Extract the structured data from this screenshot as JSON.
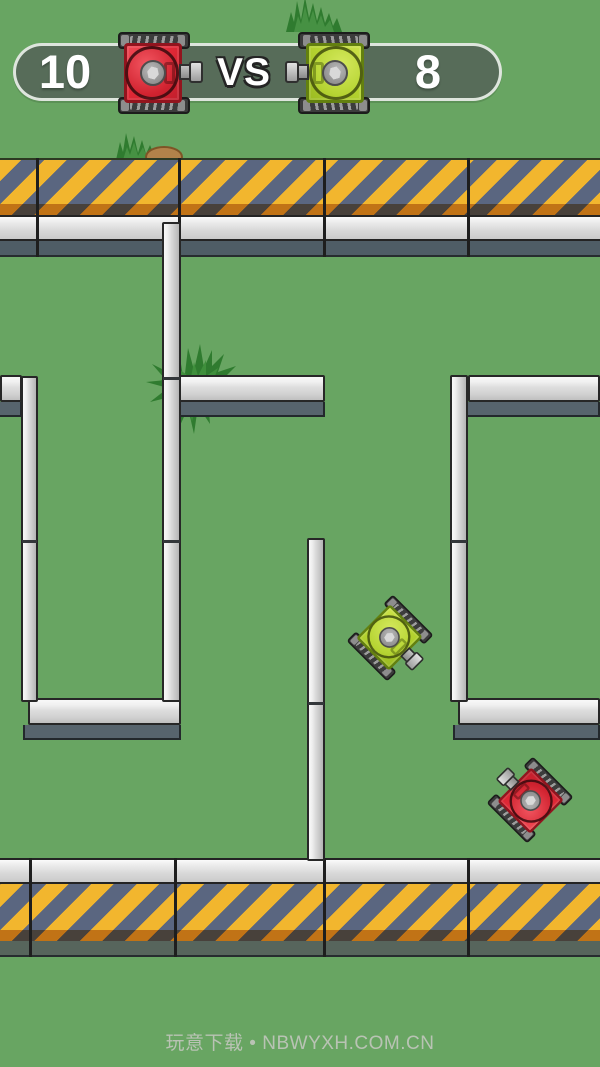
{
  "scoreboard": {
    "left_score": "10",
    "vs_label": "VS",
    "right_score": "8",
    "left_tank_icon": "red-tank-icon",
    "right_tank_icon": "green-tank-icon"
  },
  "footer": {
    "credit": "玩意下载 • NBWYXH.COM.CN"
  },
  "colors": {
    "field_green": "#68a562",
    "stripe_yellow": "#f2b62e",
    "stripe_slate": "#5a6680",
    "stripe_shadow_orange": "#b97a1f",
    "wall_face_light": "#d8d8d8",
    "wall_drop_shadow": "#57646d",
    "barrier_shadow_top": "#4f5d66",
    "barrier_shadow_bottom": "#57655c",
    "pill_fill": "#576c59",
    "pill_border": "#e9f0e8",
    "score_text": "#ffffff",
    "red_tank_body": "#e02836",
    "green_tank_body": "#b4d22f",
    "tread_dark": "#3c3c3c",
    "grass_green_dark": "#2f7b2f",
    "grass_green_light": "#469143",
    "dirt_brown": "#b2824a",
    "footer_text": "#b9c3b4"
  },
  "playfield": {
    "tanks": [
      {
        "name": "scoreboard-red-tank-icon",
        "color": "red",
        "x": 154,
        "y": 73,
        "rotation": 0,
        "scale": 1,
        "mirror": false,
        "layer": "scoreboard"
      },
      {
        "name": "scoreboard-green-tank-icon",
        "color": "green",
        "x": 334,
        "y": 73,
        "rotation": 0,
        "scale": 1,
        "mirror": true,
        "layer": "scoreboard"
      },
      {
        "name": "field-green-tank",
        "color": "green",
        "x": 390,
        "y": 638,
        "rotation": 45,
        "scale": 0.8,
        "mirror": false,
        "layer": "field"
      },
      {
        "name": "field-red-tank",
        "color": "red",
        "x": 530,
        "y": 800,
        "rotation": -135,
        "scale": 0.8,
        "mirror": false,
        "layer": "field"
      }
    ],
    "walls": [
      {
        "id": "wall-left-stub",
        "dir": "h",
        "x": 0,
        "y": 375,
        "w": 22
      },
      {
        "id": "wall-mid-top",
        "dir": "h",
        "x": 172,
        "y": 375,
        "w": 153
      },
      {
        "id": "wall-right-top",
        "dir": "h",
        "x": 468,
        "y": 375,
        "w": 132
      },
      {
        "id": "wall-right-mid",
        "dir": "h",
        "x": 458,
        "y": 698,
        "w": 142
      },
      {
        "id": "wall-left-bottom",
        "dir": "h",
        "x": 28,
        "y": 698,
        "w": 153
      },
      {
        "id": "wall-center-vertical",
        "dir": "v",
        "x": 162,
        "y": 222,
        "w": 19,
        "h": 480,
        "seams": [
          153,
          316
        ]
      },
      {
        "id": "wall-left-vertical",
        "dir": "v",
        "x": 21,
        "y": 376,
        "w": 17,
        "h": 326,
        "seams": [
          162
        ]
      },
      {
        "id": "wall-right-vertical",
        "dir": "v",
        "x": 450,
        "y": 375,
        "w": 18,
        "h": 327,
        "seams": [
          163
        ]
      },
      {
        "id": "wall-lower-vertical",
        "dir": "v",
        "x": 307,
        "y": 538,
        "w": 18,
        "h": 323,
        "seams": [
          162
        ]
      }
    ],
    "barriers": {
      "top": {
        "y": 158,
        "dividers": [
          36,
          178,
          323,
          467
        ]
      },
      "bottom": {
        "y": 858,
        "dividers": [
          29,
          174,
          323,
          467
        ]
      }
    }
  }
}
